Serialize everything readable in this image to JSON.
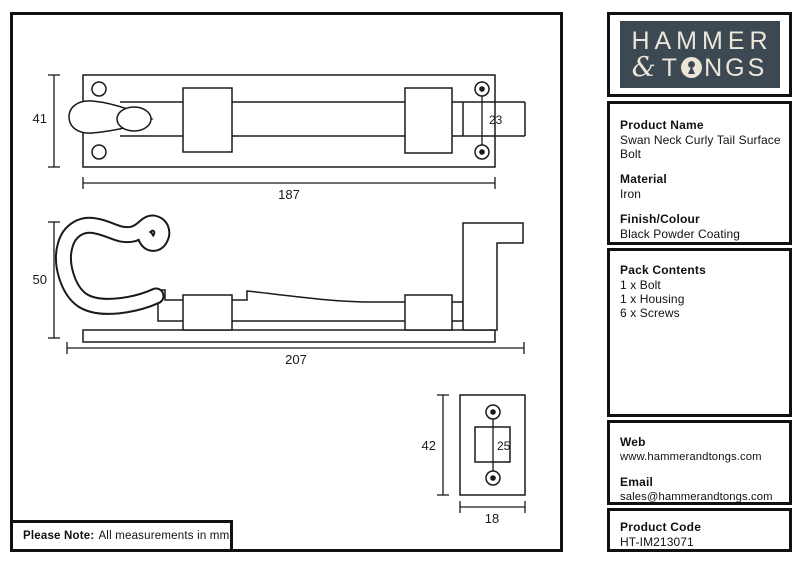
{
  "note": {
    "bold_label": "Please Note:",
    "text": "All measurements in mm"
  },
  "logo": {
    "line1": "HAMMER",
    "ampersand": "&",
    "line2_pre": "T",
    "line2_post": "NGS"
  },
  "sidebar": {
    "product_name": {
      "heading": "Product Name",
      "line1": "Swan Neck Curly Tail Surface",
      "line2": "Bolt"
    },
    "material": {
      "heading": "Material",
      "value": "Iron"
    },
    "finish": {
      "heading": "Finish/Colour",
      "value": "Black Powder Coating"
    },
    "pack": {
      "heading": "Pack Contents",
      "items": [
        "1 x Bolt",
        "1 x Housing",
        "6 x Screws"
      ]
    },
    "web": {
      "heading": "Web",
      "value": "www.hammerandtongs.com"
    },
    "email": {
      "heading": "Email",
      "value": "sales@hammerandtongs.com"
    },
    "code": {
      "heading": "Product Code",
      "value": "HT-IM213071"
    }
  },
  "drawings": {
    "top_view": {
      "plate_height_mm": "41",
      "screw_spacing_mm": "23",
      "plate_length_mm": "187"
    },
    "side_view": {
      "height_mm": "50",
      "length_mm": "207"
    },
    "keeper_plate": {
      "height_mm": "42",
      "bolt_hole_mm": "25",
      "width_mm": "18"
    }
  },
  "colors": {
    "logo_bg": "#3c4852",
    "logo_text": "#ebe6d9",
    "line": "#1a1a1a"
  }
}
